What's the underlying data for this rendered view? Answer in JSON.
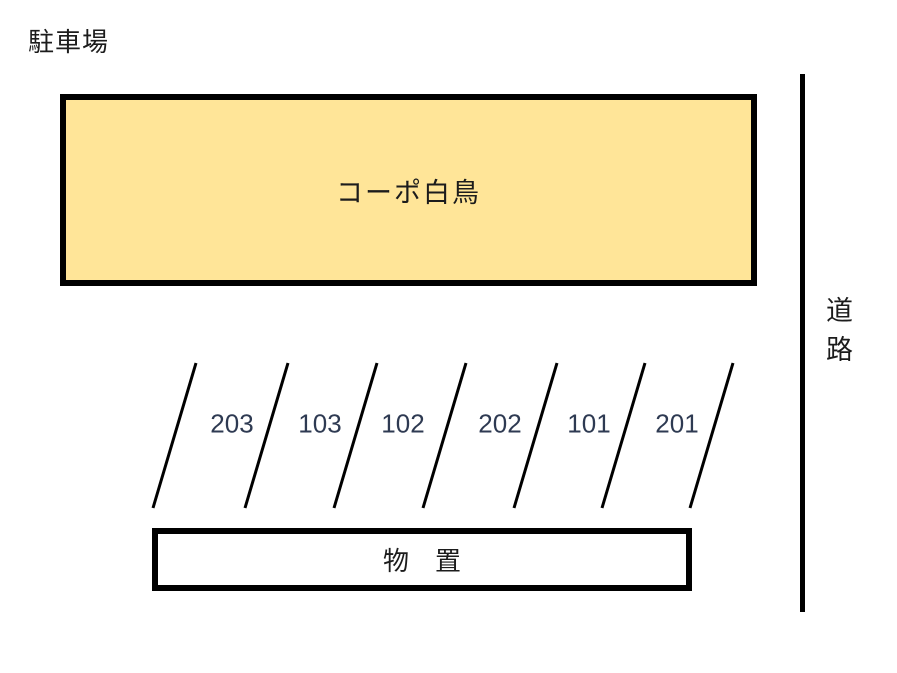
{
  "page": {
    "title": "駐車場"
  },
  "building": {
    "label": "コーポ白鳥",
    "fill_color": "#FFE598"
  },
  "parking": {
    "spaces": [
      "203",
      "103",
      "102",
      "202",
      "101",
      "201"
    ],
    "stall_count": 6,
    "divider_line_count": 7
  },
  "storage": {
    "label": "物　置"
  },
  "road": {
    "label": "道路"
  },
  "colors": {
    "building_fill": "#FFE598",
    "outline_black": "#000000",
    "space_number_text": "#2E3A52",
    "background": "#FFFFFF"
  }
}
